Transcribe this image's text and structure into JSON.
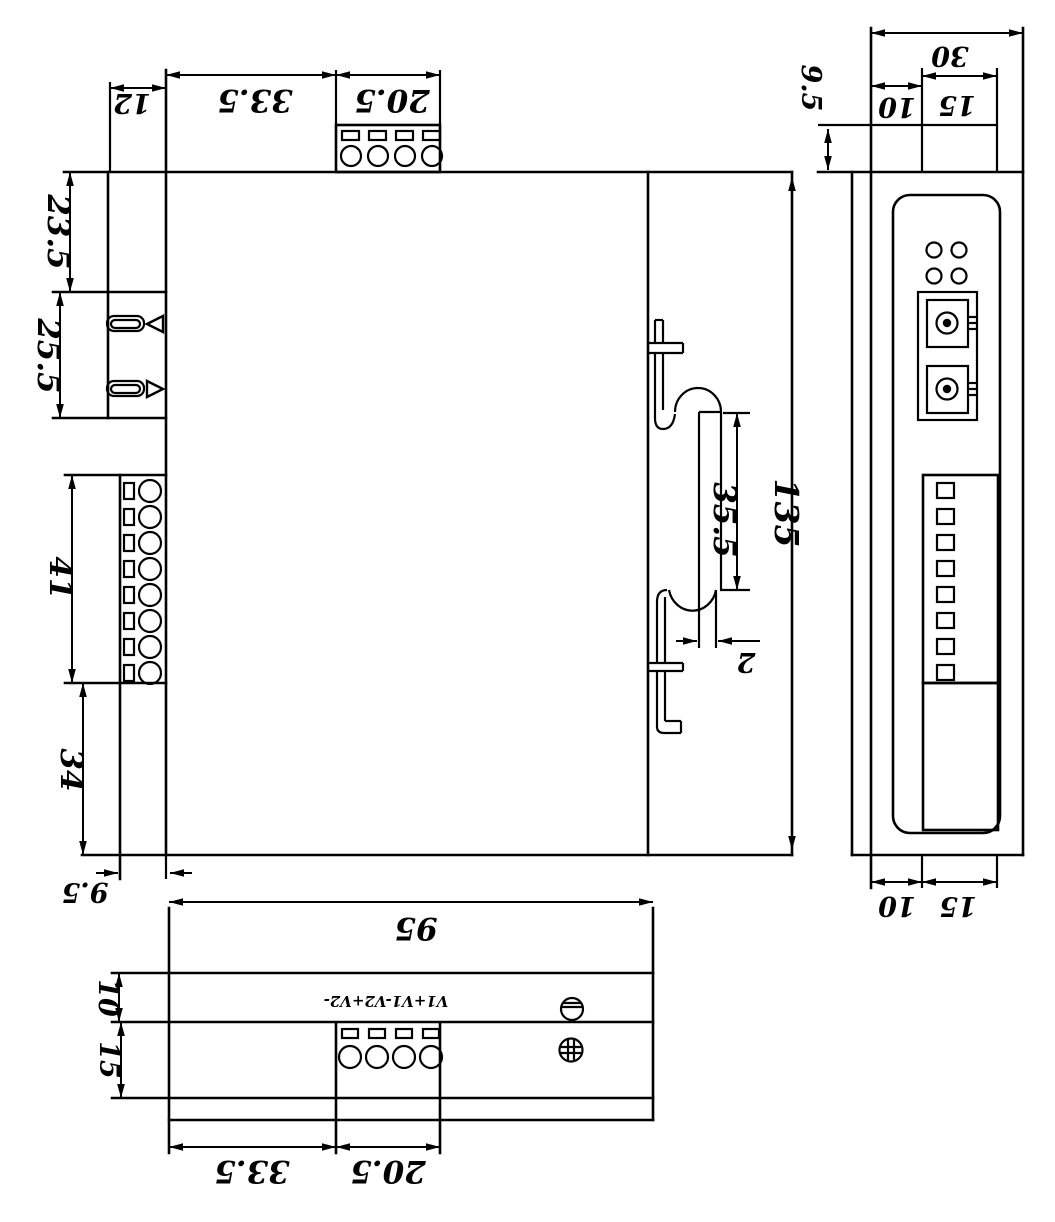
{
  "page": {
    "width": "1055",
    "height": "1222",
    "background": "#ffffff",
    "line_color": "#000000"
  },
  "views": {
    "front": {
      "dims": {
        "top_offset": "12",
        "top_seg_left": "33.5",
        "top_seg_right": "20.5",
        "upper_section": "23.5",
        "fiber_section": "25.5",
        "terminal_section": "41",
        "lower_section": "34",
        "bottom_depth": "9.5"
      }
    },
    "side": {
      "dims": {
        "rail_opening": "35.5",
        "total_height": "135",
        "rail_lip": "2"
      }
    },
    "right": {
      "dims": {
        "total_depth": "30",
        "top_step_height": "9.5",
        "top_seg1": "10",
        "top_seg2": "15",
        "bottom_seg1": "10",
        "bottom_seg2": "15"
      }
    },
    "bottom": {
      "terminal_label": "V1+V1-V2+V2-",
      "dims": {
        "total_width": "95",
        "front_depth": "10",
        "terminal_depth": "15",
        "seg_left": "33.5",
        "seg_right": "20.5"
      }
    }
  }
}
